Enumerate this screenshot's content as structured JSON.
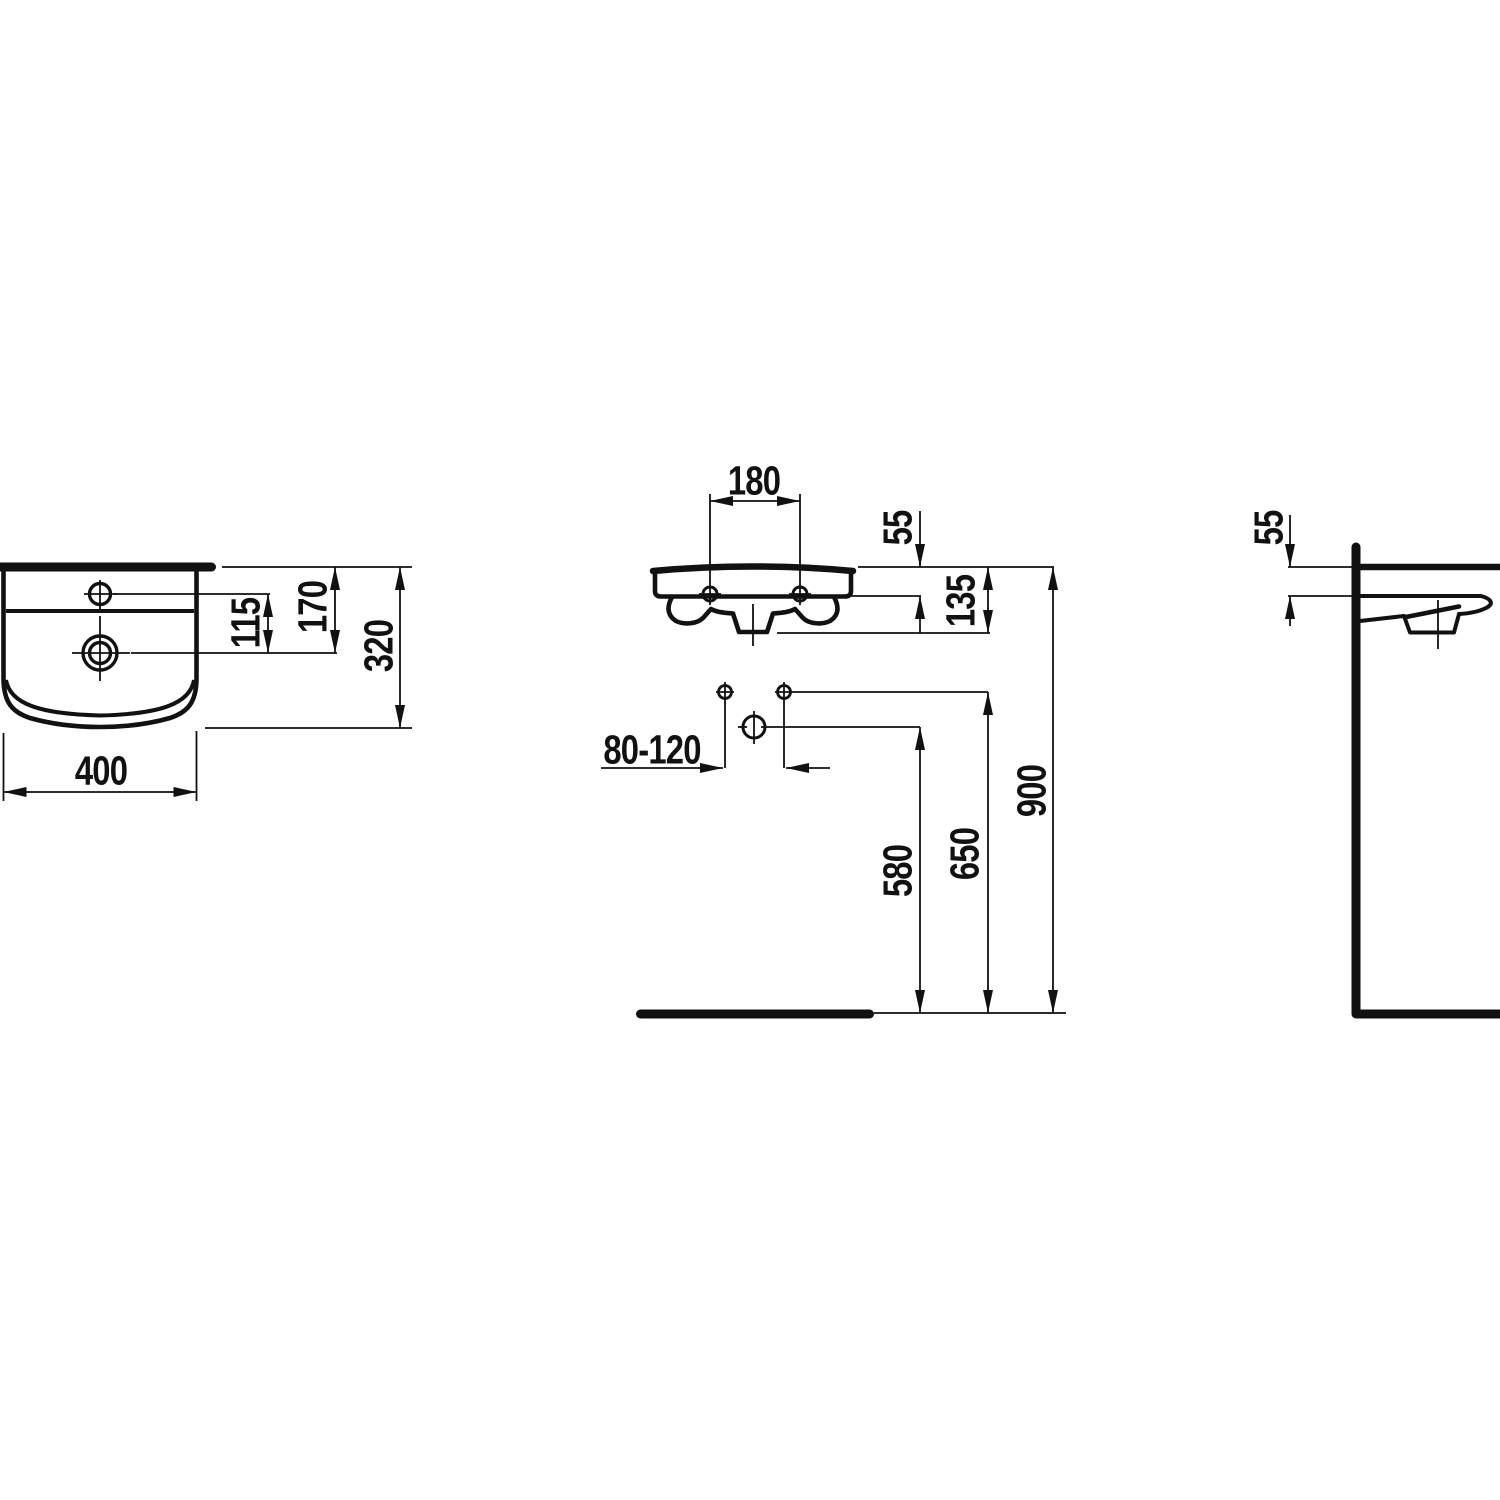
{
  "page": {
    "background": "#ffffff",
    "line_color": "#111111",
    "kind": "washbasin installation technical drawing",
    "units": "mm"
  },
  "drawing": {
    "views": {
      "top": {
        "title": "top view",
        "dims": {
          "tap_to_drain": "115",
          "wall_to_drain": "170",
          "depth": "320",
          "width": "400"
        }
      },
      "front": {
        "title": "front view",
        "dims": {
          "fixing_spacing": "180",
          "rim_to_fixing": "55",
          "rim_to_trap": "135",
          "supply_spacing": "80-120",
          "floor_to_trap": "580",
          "floor_to_supply": "650",
          "floor_to_rim": "900"
        }
      },
      "side": {
        "title": "side view",
        "dims": {
          "rim_to_underside": "55"
        }
      }
    }
  }
}
